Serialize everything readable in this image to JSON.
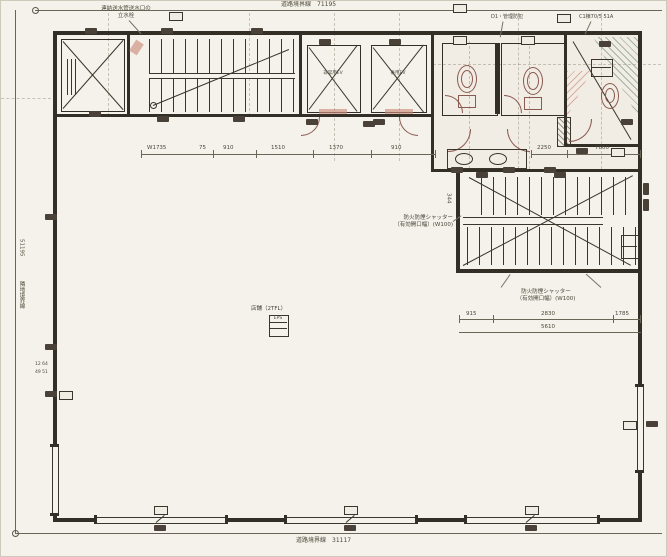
{
  "boundaries": {
    "top": "道路境界線　71195",
    "bottom": "道路境界線　31117",
    "left_number": "51195",
    "left_label": "隣地境界線"
  },
  "notes": {
    "hydrant_l1": "連結送水管送水口の",
    "hydrant_l2": "立水栓",
    "security": "D1・管理防犯",
    "top_right": "C1棟70/5 51A",
    "shutter_l1": "防火防煙シャッター",
    "shutter_l2": "（有効開口幅）(W100)"
  },
  "labels": {
    "ev1": "非常用EV",
    "ev2": "乗用EV",
    "center": "店舗（2TFL）",
    "center_tag": "EPS",
    "stair_v": "344"
  },
  "dims": {
    "top_row": [
      "W1735",
      "75",
      "910",
      "1510",
      "1370",
      "910"
    ],
    "toilet_a": "2250",
    "toilet_b": "7800",
    "stair_row": [
      "915",
      "2830",
      "1785"
    ],
    "stair_total": "5610",
    "left_a": "12 64",
    "left_b": "49 51"
  }
}
